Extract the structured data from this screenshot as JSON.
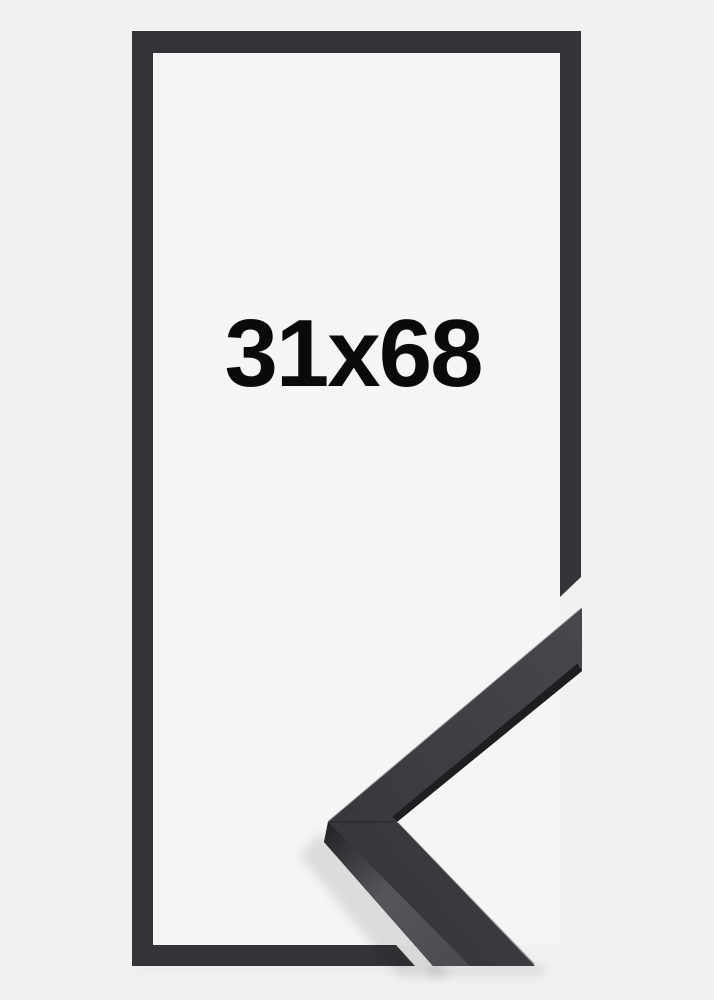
{
  "page": {
    "background_color": "#f1f1f2",
    "opening_background_color": "#f5f5f6"
  },
  "product": {
    "size_label": "31x68",
    "label_color": "#0a0a0a",
    "frame_color": "#343438",
    "moulding_sample": {
      "face_color_light": "#46464c",
      "face_color_dark": "#38383c",
      "inner_lip_color": "#1e1e21",
      "side_color_corner": "#26262a",
      "side_color_mid": "#55555b",
      "side_color_end": "#4b4b51",
      "highlight_color": "#74747a"
    }
  }
}
